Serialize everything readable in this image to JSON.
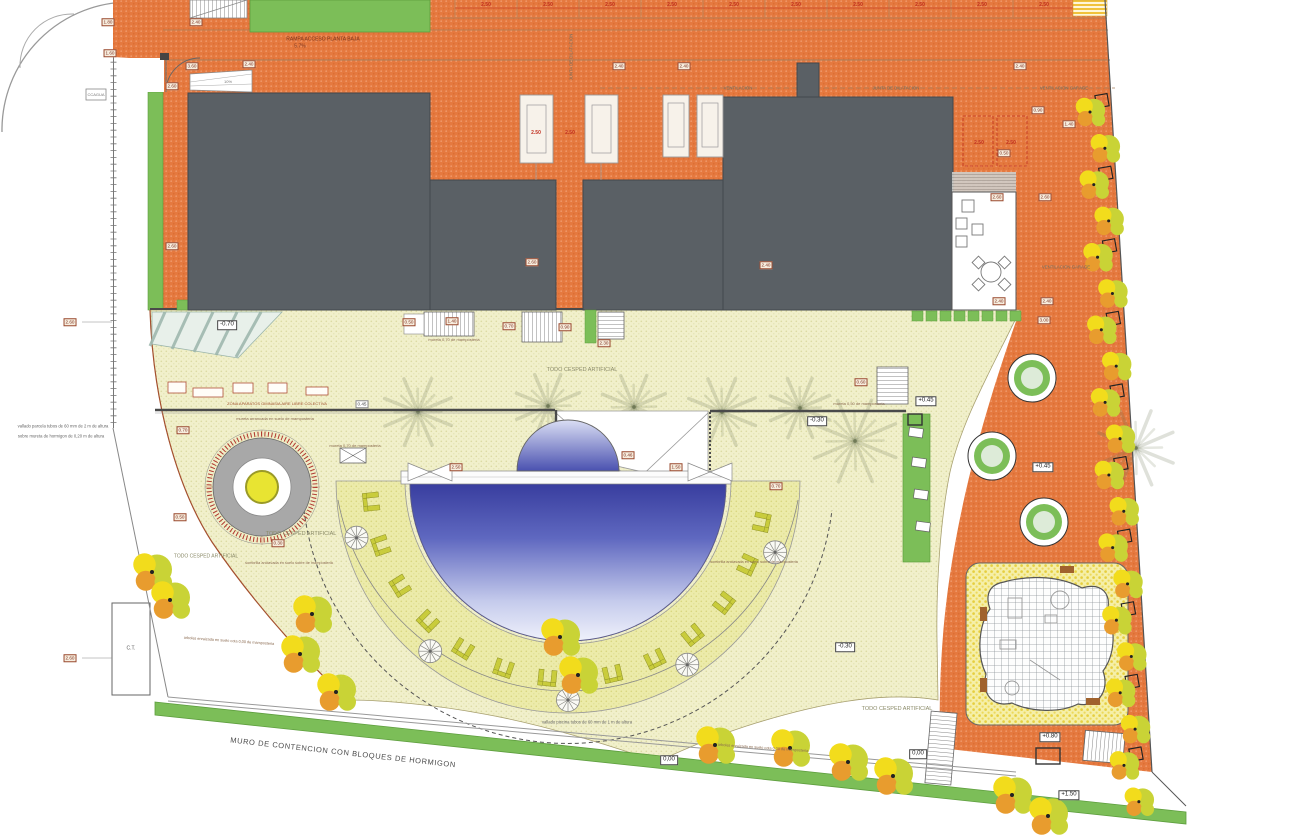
{
  "plan": {
    "drawing_name": "site-plan-landscaping",
    "colors": {
      "paving_orange": "#E5793F",
      "building_gray": "#5A6065",
      "lawn_green": "#7CBE58",
      "artificial_grass_cream": "#F1F0CB",
      "pool_deck_yellow": "#EBEBA9",
      "pool_blue_dark": "#383D9E",
      "pool_blue_light": "#EFF1FB",
      "tree_yellow": "#F2DC1C",
      "tree_green": "#C9D336",
      "tree_orange": "#E89C2E",
      "marker_red": "#B03830"
    },
    "labels": [
      {
        "id": "rampa",
        "text": "RAMPA ACCESO PLANTA BAJA"
      },
      {
        "id": "rampa_pct",
        "text": "5.7%"
      },
      {
        "id": "vent1",
        "text": "VENTILACION"
      },
      {
        "id": "junta1",
        "text": "JUNTA DE DILATACION"
      },
      {
        "id": "ventgar1",
        "text": "VENTILACION GARAGE"
      },
      {
        "id": "junta2",
        "text": "JUNTA DE DILATACION"
      },
      {
        "id": "ventgar2",
        "text": "VENTILACION GARAGE"
      },
      {
        "id": "ccagua",
        "text": "CCAGUA"
      },
      {
        "id": "cesped1",
        "text": "TODO CESPED ARTIFICIAL"
      },
      {
        "id": "cesped2",
        "text": "TODO CESPED ARTIFICIAL"
      },
      {
        "id": "cesped3",
        "text": "TODO CESPED ARTIFICIAL"
      },
      {
        "id": "cesped4",
        "text": "TODO CESPED ARTIFICIAL"
      },
      {
        "id": "zona_aparatos",
        "text": "ZONA APARATOS GIMNASIA AIRE LIBRE COLECTIVA"
      },
      {
        "id": "mureta1",
        "text": "mureta arrancada en suelo de mamposteria"
      },
      {
        "id": "mureta2",
        "text": "mureta 0,70 de mamposteria"
      },
      {
        "id": "mureta3",
        "text": "mureta 0,70 de mamposteria"
      },
      {
        "id": "mureta4",
        "text": "mureta 0,50 de mamposteria"
      },
      {
        "id": "vallado1",
        "text": "vallado parcela tubos de 60 mm de 2 m de altura"
      },
      {
        "id": "vallado2",
        "text": "sobre mureta de hormigon de 0,20 m de altura"
      },
      {
        "id": "vallado_piscina",
        "text": "vallado piscina tubos de 60 mm de 1 m de altura"
      },
      {
        "id": "muro",
        "text": "MURO DE CONTENCION  CON BLOQUES DE HORMIGON"
      },
      {
        "id": "arboles1",
        "text": "arboles enraizada en suelo cota 0,00 de mamposteria"
      },
      {
        "id": "arboles2",
        "text": "arboles enraizada en suelo cota 0,00 de mamposteria"
      },
      {
        "id": "sombrilla1",
        "text": "sombrilla anclavada en suelo sobre de mamposteria"
      },
      {
        "id": "sombrilla2",
        "text": "sombrilla anclavada en suelo sobre de mamposteria"
      },
      {
        "id": "ct",
        "text": "C.T."
      },
      {
        "id": "pct10",
        "text": "10%"
      }
    ],
    "levels": [
      {
        "id": "lv1",
        "text": "-0.70"
      },
      {
        "id": "lv2",
        "text": "+0.45"
      },
      {
        "id": "lv3",
        "text": "+0.45"
      },
      {
        "id": "lv4",
        "text": "-0.30"
      },
      {
        "id": "lv5",
        "text": "-0.30"
      },
      {
        "id": "lv6",
        "text": "0,00"
      },
      {
        "id": "lv7",
        "text": "0,00"
      },
      {
        "id": "lv8",
        "text": "+0.80"
      },
      {
        "id": "lv9",
        "text": "+1.50"
      }
    ],
    "dims": [
      {
        "id": "dm1",
        "text": "1.80"
      },
      {
        "id": "dm2",
        "text": "1.60"
      },
      {
        "id": "dm3",
        "text": "2.40"
      },
      {
        "id": "dm4",
        "text": "3.60"
      },
      {
        "id": "dm5",
        "text": "2.60"
      },
      {
        "id": "dm6",
        "text": "2.40"
      },
      {
        "id": "dm7",
        "text": "2.60"
      },
      {
        "id": "dm8",
        "text": "2.40"
      },
      {
        "id": "dm9",
        "text": "2.40"
      },
      {
        "id": "dm10",
        "text": "2.60"
      },
      {
        "id": "dm11",
        "text": "2.40"
      },
      {
        "id": "dm12",
        "text": "2.40"
      },
      {
        "id": "dm13",
        "text": "0.90"
      },
      {
        "id": "dm14",
        "text": "1.40"
      },
      {
        "id": "dm15",
        "text": "0.50"
      },
      {
        "id": "dm16",
        "text": "2.60"
      },
      {
        "id": "dm17",
        "text": "2.40"
      },
      {
        "id": "dm18",
        "text": "2.60"
      },
      {
        "id": "dm19",
        "text": "2.40"
      },
      {
        "id": "dm20",
        "text": "0.50"
      },
      {
        "id": "dm21",
        "text": "1.40"
      },
      {
        "id": "dm22",
        "text": "0.70"
      },
      {
        "id": "dm23",
        "text": "0.90"
      },
      {
        "id": "dm24",
        "text": "2.30"
      },
      {
        "id": "dm25",
        "text": "0.45"
      },
      {
        "id": "dm26",
        "text": "0.70"
      },
      {
        "id": "dm27",
        "text": "0.50"
      },
      {
        "id": "dm28",
        "text": "0.30"
      },
      {
        "id": "dm29",
        "text": "2.50"
      },
      {
        "id": "dm30",
        "text": "1.50"
      },
      {
        "id": "dm31",
        "text": "0.70"
      },
      {
        "id": "dm32",
        "text": "0.60"
      },
      {
        "id": "dm33",
        "text": "2.60"
      },
      {
        "id": "dm34",
        "text": "2.60"
      },
      {
        "id": "dm35",
        "text": "0.46"
      },
      {
        "id": "dm36",
        "text": "3.00"
      },
      {
        "id": "dm38",
        "text": "2.50"
      },
      {
        "id": "dm39",
        "text": "2.50"
      },
      {
        "id": "dm40",
        "text": "2.50"
      },
      {
        "id": "dm41",
        "text": "2.50"
      }
    ],
    "parking_row": {
      "dim": "2.50",
      "count": 10
    }
  }
}
